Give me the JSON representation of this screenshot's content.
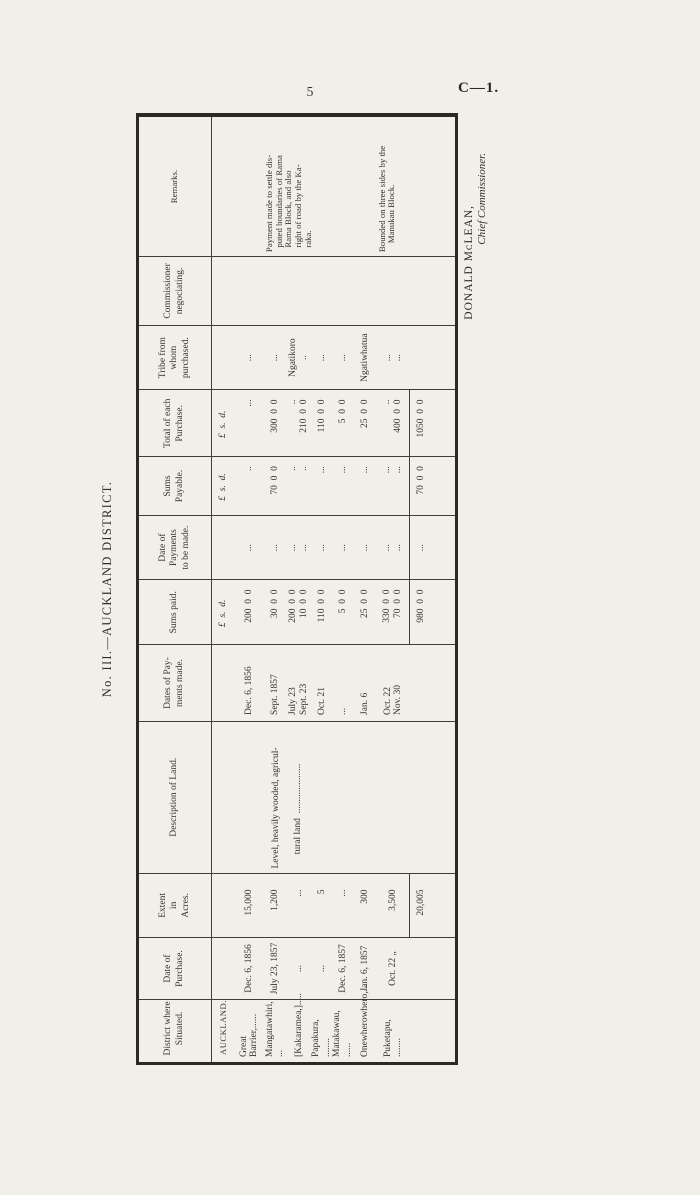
{
  "page": {
    "page_number": "5",
    "doc_code": "C—1.",
    "title": "No. III.—AUCKLAND DISTRICT.",
    "signature": {
      "name": "DONALD MᴄLEAN,",
      "role": "Chief Commissioner."
    }
  },
  "table": {
    "columns": [
      {
        "id": "district",
        "label": "District where\nSituated."
      },
      {
        "id": "date_purchase",
        "label": "Date of\nPurchase."
      },
      {
        "id": "extent",
        "label": "Extent\nin\nAcres."
      },
      {
        "id": "description",
        "label": "Description of Land."
      },
      {
        "id": "dates_paid",
        "label": "Dates of Pay-\nments made."
      },
      {
        "id": "sums_paid",
        "label": "Sums paid."
      },
      {
        "id": "date_due",
        "label": "Date of\nPayments\nto be made."
      },
      {
        "id": "sums_payable",
        "label": "Sums\nPayable."
      },
      {
        "id": "total",
        "label": "Total of each\nPurchase."
      },
      {
        "id": "tribe",
        "label": "Tribe from\nwhom\npurchased."
      },
      {
        "id": "commissioner",
        "label": "Commissioner\nnegociating."
      },
      {
        "id": "remarks",
        "label": "Remarks."
      }
    ],
    "rows": [
      {
        "type": "section",
        "district": "AUCKLAND.",
        "sums_paid": "£ s. d.",
        "sums_payable": "£ s. d.",
        "total": "£ s. d."
      },
      {
        "type": "data",
        "district": "Great Barrier,......",
        "date_purchase": "Dec. 6, 1856",
        "extent": "15,000",
        "description": "",
        "dates_paid": "Dec. 6, 1856",
        "sums_paid": "200 0 0",
        "date_due": "...",
        "sums_payable": "..",
        "total": "...",
        "tribe": "...",
        "commissioner": "",
        "remarks": ""
      },
      {
        "type": "data",
        "district": "Mangatawhiri, ...",
        "date_purchase": "July 23, 1857",
        "extent": "1,200",
        "description": "Level, heavily wooded, agricul-\n  tural land .....................",
        "dates_paid": "Sept. 1857",
        "sums_paid": "30 0 0",
        "date_due": "...",
        "sums_payable": "70 0 0",
        "total": "300 0 0",
        "tribe": "...",
        "commissioner": "",
        "remarks": "Payment made to settle dis-\n puted boundaries of Rama\n Rama Block,  and  also\n right of road by the Ka-\n raka."
      },
      {
        "type": "data",
        "district": "[Kakaramea,].....",
        "date_purchase": "...",
        "extent": "...",
        "description": "",
        "dates_paid": "July 23\nSept. 23",
        "sums_paid": "200 0 0\n10 0 0",
        "date_due": "...\n...",
        "sums_payable": "..\n..",
        "total": "..\n210 0 0",
        "tribe": "Ngatikoro\n..",
        "commissioner": "",
        "remarks": ""
      },
      {
        "type": "data",
        "district": "Papakura, ........",
        "date_purchase": "...",
        "extent": "5",
        "description": "",
        "dates_paid": "Oct. 21",
        "sums_paid": "110 0 0",
        "date_due": "...",
        "sums_payable": "...",
        "total": "110 0 0",
        "tribe": "...",
        "commissioner": "",
        "remarks": ""
      },
      {
        "type": "data",
        "district": "Matakawau, ......",
        "date_purchase": "Dec. 6, 1857",
        "extent": "...",
        "description": "",
        "dates_paid": "...",
        "sums_paid": "5 0 0",
        "date_due": "...",
        "sums_payable": "...",
        "total": "5 0 0",
        "tribe": "...",
        "commissioner": "",
        "remarks": ""
      },
      {
        "type": "data",
        "district": "Onewherowhero,...",
        "date_purchase": "Jan. 6, 1857",
        "extent": "300",
        "description": "",
        "dates_paid": "Jan. 6",
        "sums_paid": "25 0 0",
        "date_due": "...",
        "sums_payable": "...",
        "total": "25 0 0",
        "tribe": "Ngatiwhatua",
        "commissioner": "",
        "remarks": ""
      },
      {
        "type": "data",
        "district": "Puketapu, ........",
        "date_purchase": "Oct. 22 „",
        "extent": "3,500",
        "description": "",
        "dates_paid": "Oct. 22\nNov. 30",
        "sums_paid": "330 0 0\n70 0 0",
        "date_due": "...\n...",
        "sums_payable": "...\n...",
        "total": "..\n400 0 0",
        "tribe": "...\n...",
        "commissioner": "",
        "remarks": "Bounded on three sides by the\n Manukau Block."
      },
      {
        "type": "total",
        "district": "",
        "date_purchase": "",
        "extent": "20,005",
        "description": "",
        "dates_paid": "",
        "sums_paid": "980 0 0",
        "date_due": "...",
        "sums_payable": "70 0 0",
        "total": "1050 0 0",
        "tribe": "",
        "commissioner": "",
        "remarks": ""
      }
    ]
  }
}
